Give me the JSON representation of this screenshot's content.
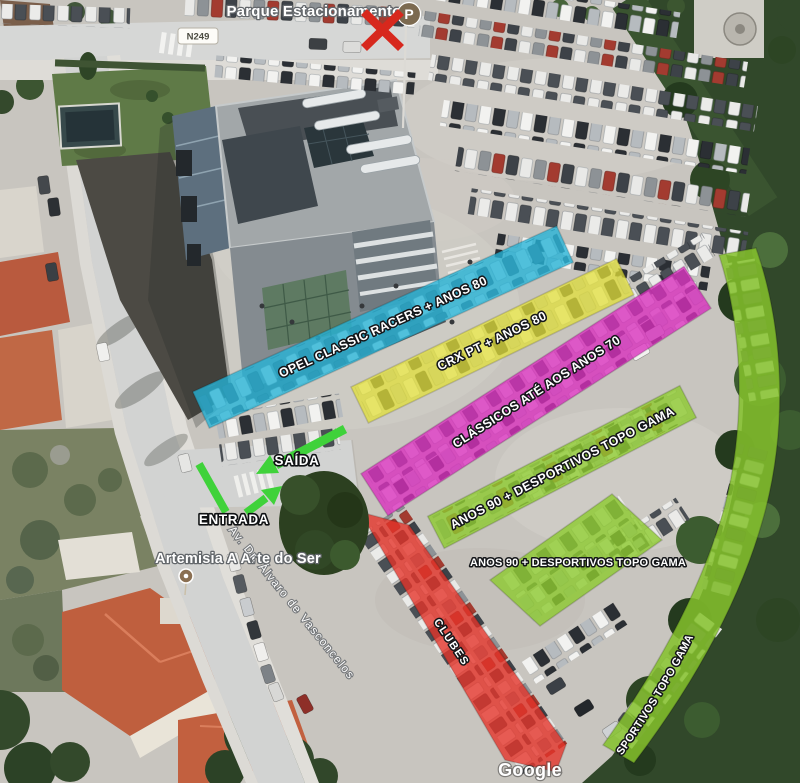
{
  "map": {
    "attribution": "Google",
    "road_badge": "N249",
    "street_name": "Av. Dr. Álvaro de Vasconcelos",
    "pois": {
      "parking": {
        "label": "Parque Estacionamento",
        "marker_letter": "P"
      },
      "artemisia": {
        "label": "Artemisia A Arte do Ser"
      }
    }
  },
  "zones": [
    {
      "id": "opel-classic",
      "label": "OPEL CLASSIC RACERS + ANOS 80",
      "color": "#25b4d8"
    },
    {
      "id": "crx-pt",
      "label": "CRX PT + ANOS 80",
      "color": "#e2e03a"
    },
    {
      "id": "classicos-70",
      "label": "CLÁSSICOS ATÉ AOS ANOS 70",
      "color": "#da2fbe"
    },
    {
      "id": "anos90-row",
      "label": "ANOS 90 + DESPORTIVOS TOPO GAMA",
      "color": "#8ecb30"
    },
    {
      "id": "anos90-block",
      "label": "ANOS 90 + DESPORTIVOS TOPO GAMA",
      "color": "#8ecb30"
    },
    {
      "id": "anos90-curve",
      "label": "ANOS 90 + DESPORTIVOS TOPO GAMA",
      "color": "#85c22c"
    },
    {
      "id": "clubes",
      "label": "CLUBES",
      "color": "#e63329"
    }
  ],
  "annotations": {
    "exit": "SAÍDA",
    "entrance": "ENTRADA"
  },
  "colors": {
    "arrow_green": "#3fd23a",
    "cross_red": "#d7281d",
    "marker_brown": "#7c6a50"
  }
}
